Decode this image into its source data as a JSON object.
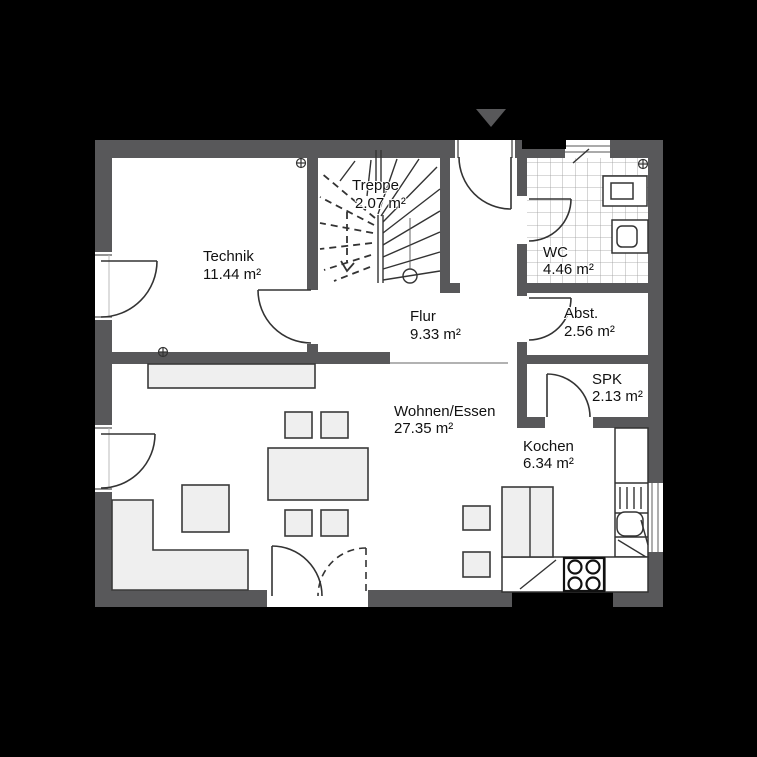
{
  "plan": {
    "type": "floor-plan",
    "colors": {
      "background": "#000000",
      "wall": "#58585a",
      "floor": "#ffffff",
      "furniture_fill": "#efefef",
      "line": "#333333",
      "tile_grid": "#9a9a9a",
      "label_text": "#111111"
    },
    "entrance_arrow_icon": "▼"
  },
  "rooms": [
    {
      "id": "technik",
      "name": "Technik",
      "area": "11.44 m²"
    },
    {
      "id": "treppe",
      "name": "Treppe",
      "area": "2.07 m²"
    },
    {
      "id": "wc",
      "name": "WC",
      "area": "4.46 m²"
    },
    {
      "id": "flur",
      "name": "Flur",
      "area": "9.33 m²"
    },
    {
      "id": "abst",
      "name": "Abst.",
      "area": "2.56 m²"
    },
    {
      "id": "spk",
      "name": "SPK",
      "area": "2.13 m²"
    },
    {
      "id": "wohnen",
      "name": "Wohnen/Essen",
      "area": "27.35 m²"
    },
    {
      "id": "kochen",
      "name": "Kochen",
      "area": "6.34 m²"
    }
  ]
}
